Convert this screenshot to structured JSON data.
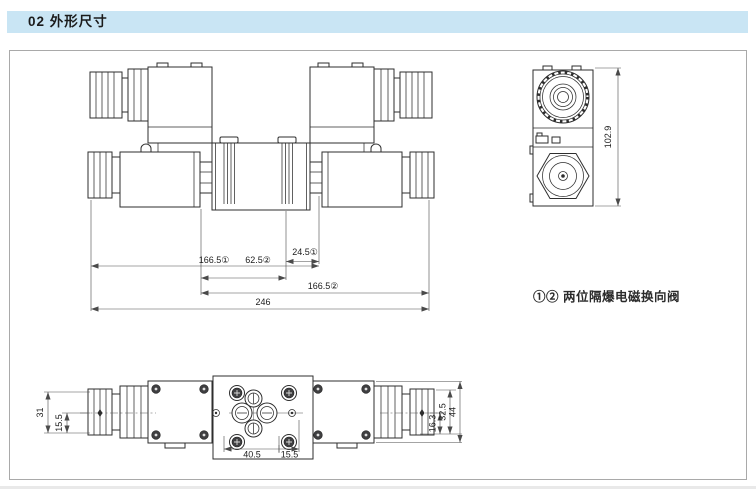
{
  "header": {
    "title": "02 外形尺寸"
  },
  "drawing": {
    "caption": "①②  两位隔爆电磁换向阀",
    "front_view": {
      "dim_24_5": "24.5①",
      "dim_166_5_a": "166.5①",
      "dim_62_5": "62.5②",
      "dim_166_5_b": "166.5②",
      "dim_246": "246"
    },
    "side_view": {
      "dim_height": "102.9"
    },
    "top_view": {
      "dim_31": "31",
      "dim_15_5_left": "15.5",
      "dim_16_3": "16.3",
      "dim_32_5": "32.5",
      "dim_44": "44",
      "dim_40_5": "40.5",
      "dim_15_5_bottom": "15.5"
    }
  }
}
